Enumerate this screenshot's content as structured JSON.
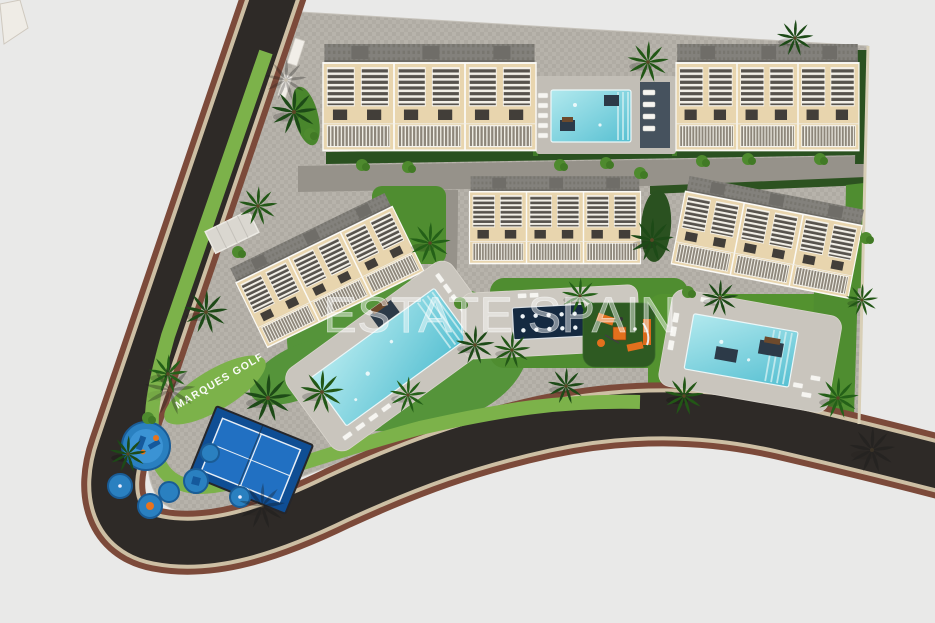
{
  "labels": {
    "watermark": "ESTATE SPAIN",
    "street": "MARQUES GOLF"
  },
  "scene": {
    "description": "Bird's-eye 3D architectural rendering of a gated residential golf-resort complex: five beige apartment blocks with louvered terraces, three turquoise swimming pools, a dark jetted spa pool, paddle court, children's splash pads and playground, lawns, hedges and palm trees, bounded by a curving asphalt perimeter road with red-brown sidewalks.",
    "style": "aerial site-plan render",
    "background": "#e9e9e8",
    "palette": {
      "asphalt": "#2e2a27",
      "sidewalk_brown": "#7c4a3a",
      "curb_cream": "#cdbfa4",
      "cobble_paving": "#b7b3ab",
      "plaza_paving": "#cac6be",
      "lawn_green": "#55943a",
      "hedge_green": "#2a5120",
      "facade_beige": "#e8d5ae",
      "roof_gray": "#83817c",
      "pool_water": "#57c0d2",
      "spa_water": "#152a41",
      "court_blue": "#2170c2",
      "play_orange": "#e2701d",
      "splash_blue": "#2a80c0"
    },
    "features": {
      "apartment_blocks": 5,
      "swimming_pools": 3,
      "spa_jet_pool": 1,
      "paddle_court": 1,
      "children_playground": 1,
      "splash_pad_circles": 7,
      "palm_trees": 20
    }
  }
}
